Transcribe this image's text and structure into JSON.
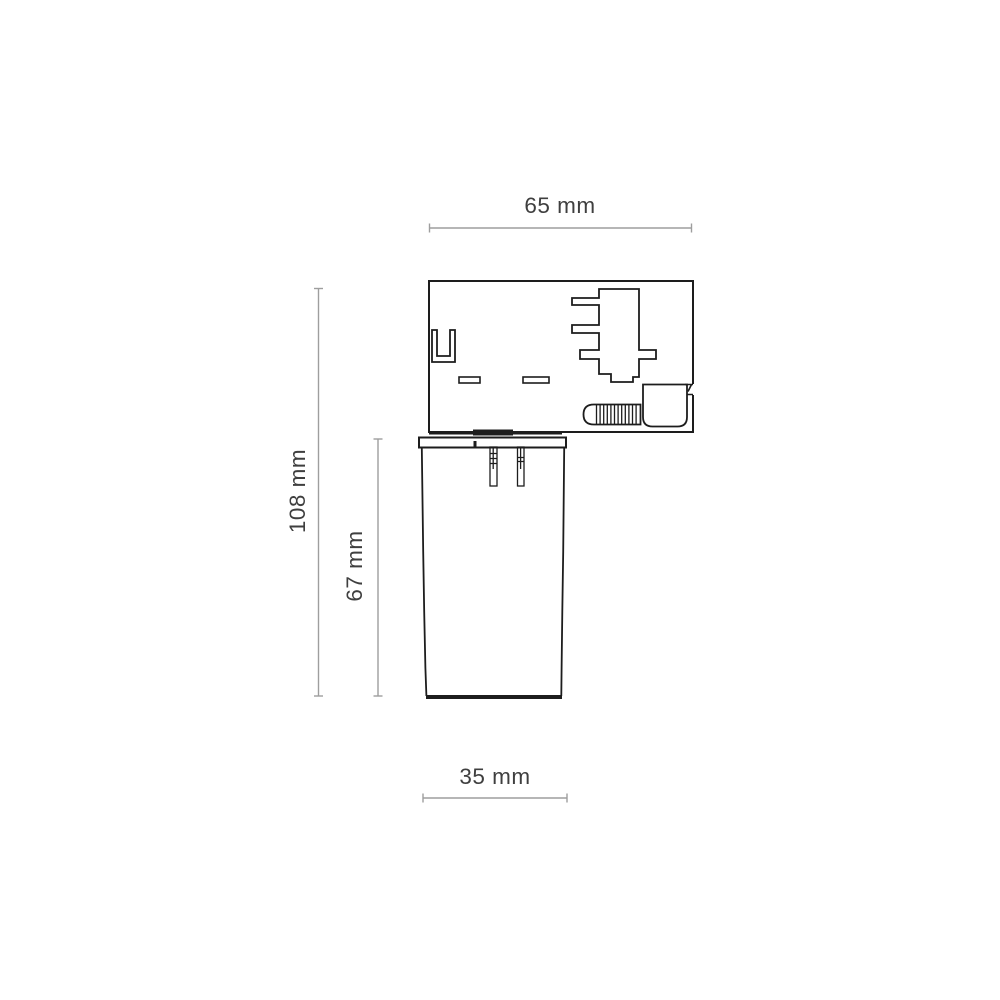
{
  "page": {
    "background": "#ffffff",
    "description": "Technical dimension drawing of a track-light adapter with cylindrical spot body"
  },
  "colors": {
    "outline": "#1d1d1d",
    "dimension_line": "#9e9e9e",
    "dimension_text": "#3f3f3f"
  },
  "dimensions": {
    "adapter_width": "65 mm",
    "overall_height": "108 mm",
    "body_height": "67 mm",
    "body_width": "35 mm"
  }
}
